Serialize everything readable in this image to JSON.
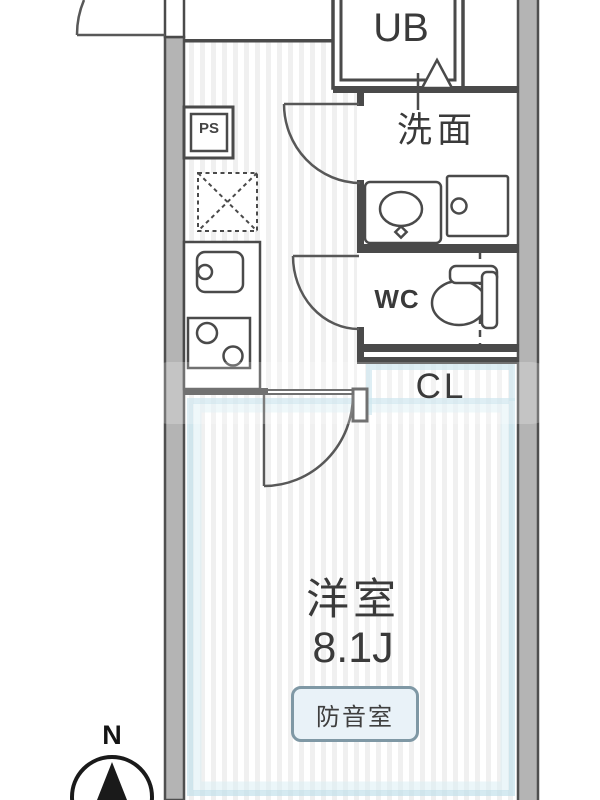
{
  "floorplan": {
    "rooms": {
      "unit_bath": {
        "label": "UB"
      },
      "washroom": {
        "label": "洗面"
      },
      "toilet": {
        "label": "WC"
      },
      "closet": {
        "label": "CL"
      },
      "pipe_space": {
        "label": "PS"
      },
      "main_room": {
        "label": "洋室",
        "size": "8.1J"
      }
    },
    "badge": {
      "label": "防音室"
    },
    "compass": {
      "north_label": "N"
    },
    "colors": {
      "wall_fill": "#b4b4b4",
      "line": "#4a4a4a",
      "room_glow": "#bedfe9",
      "stripe": "#f0f0f0",
      "badge_bg": "#e9f2f8",
      "badge_border": "#7f98a5"
    }
  }
}
